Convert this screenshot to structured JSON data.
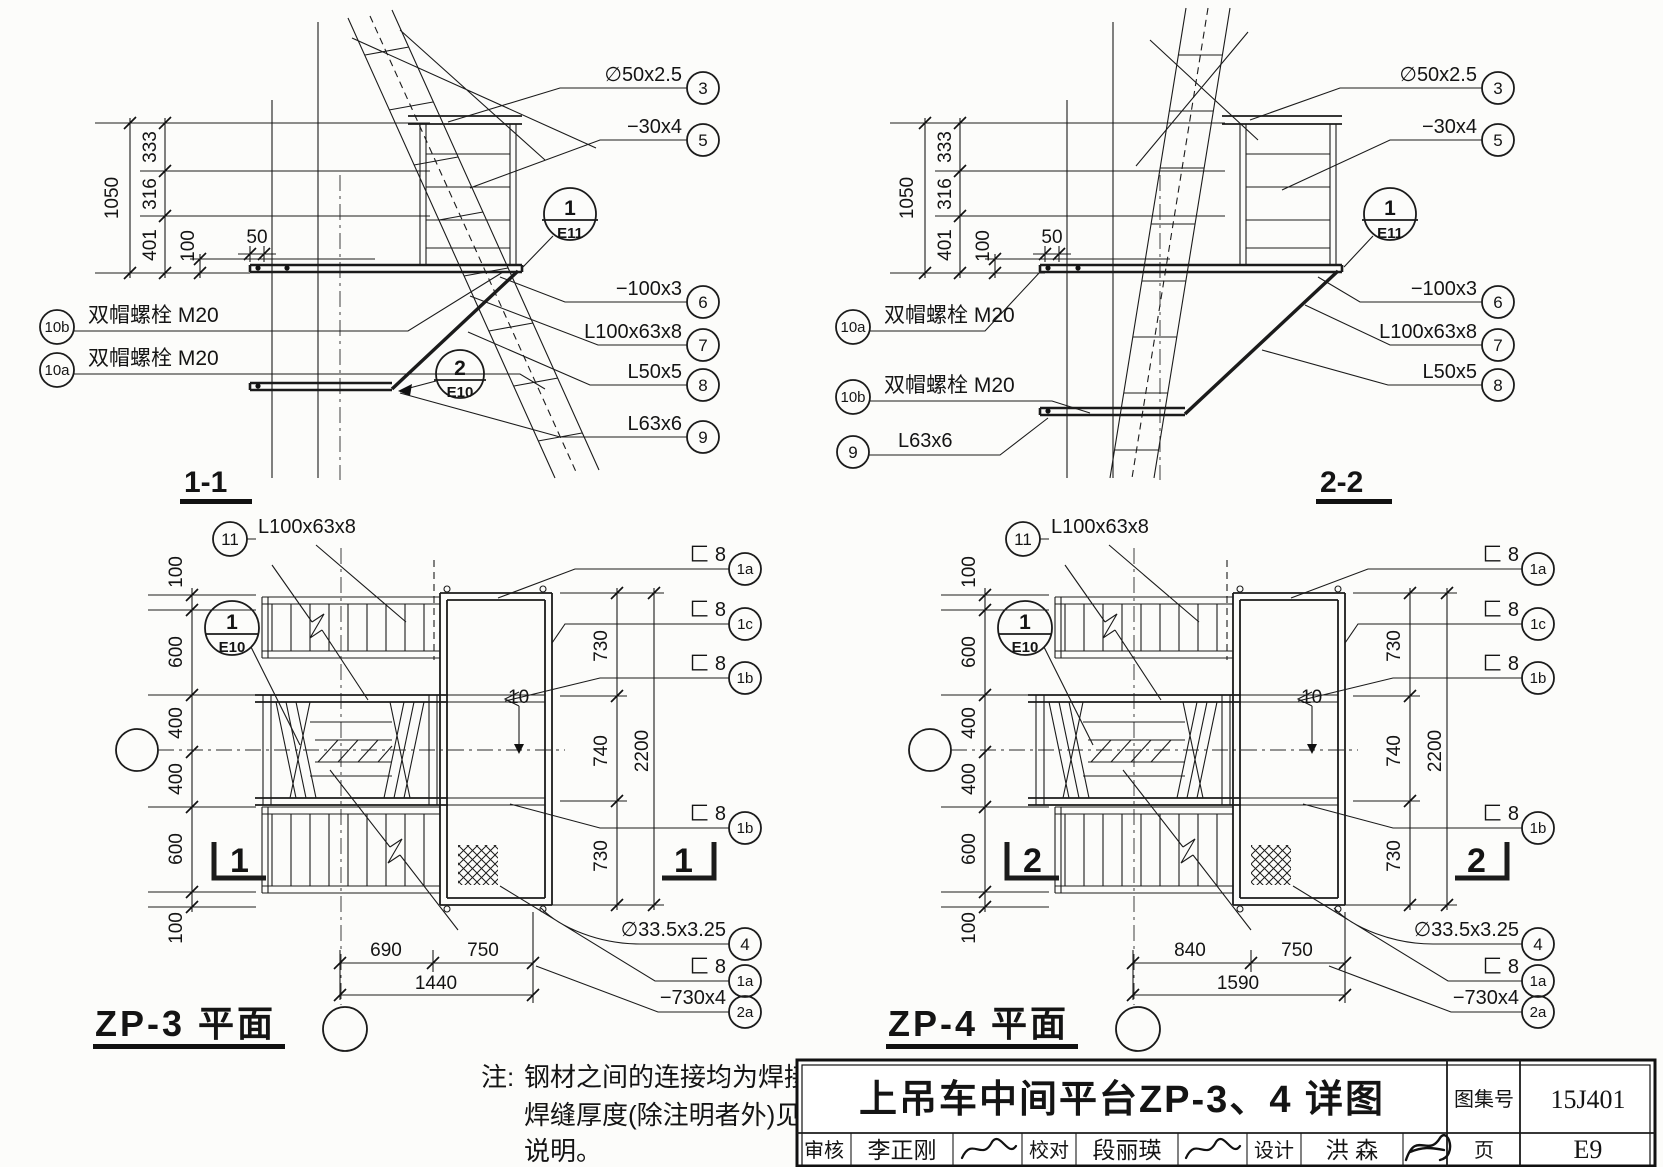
{
  "s11": {
    "title": "1-1",
    "dims": {
      "total": "1050",
      "a": "333",
      "b": "316",
      "c": "401",
      "d": "100",
      "e": "50"
    },
    "rc": [
      {
        "label": "∅50x2.5",
        "num": "3"
      },
      {
        "label": "−30x4",
        "num": "5"
      },
      {
        "label": "−100x3",
        "num": "6"
      },
      {
        "label": "L100x63x8",
        "num": "7"
      },
      {
        "label": "L50x5",
        "num": "8"
      },
      {
        "label": "L63x6",
        "num": "9"
      }
    ],
    "lc": [
      {
        "num": "10b",
        "label": "双帽螺栓 M20"
      },
      {
        "num": "10a",
        "label": "双帽螺栓 M20"
      }
    ],
    "det1": {
      "num": "1",
      "sheet": "E11"
    },
    "det2": {
      "num": "2",
      "sheet": "E10"
    }
  },
  "s22": {
    "title": "2-2",
    "dims": {
      "total": "1050",
      "a": "333",
      "b": "316",
      "c": "401",
      "d": "100",
      "e": "50"
    },
    "rc": [
      {
        "label": "∅50x2.5",
        "num": "3"
      },
      {
        "label": "−30x4",
        "num": "5"
      },
      {
        "label": "−100x3",
        "num": "6"
      },
      {
        "label": "L100x63x8",
        "num": "7"
      },
      {
        "label": "L50x5",
        "num": "8"
      }
    ],
    "lc": [
      {
        "num": "10a",
        "label": "双帽螺栓 M20"
      },
      {
        "num": "10b",
        "label": "双帽螺栓 M20"
      },
      {
        "num": "9",
        "label": "L63x6"
      }
    ],
    "det1": {
      "num": "1",
      "sheet": "E11"
    }
  },
  "zp3": {
    "title": "ZP-3 平面",
    "mark": "1",
    "ldims": [
      "100",
      "600",
      "400",
      "400",
      "600",
      "100"
    ],
    "rdims": {
      "a": "730",
      "b": "740",
      "c": "730",
      "total": "2200"
    },
    "weld": "10",
    "top": {
      "num": "11",
      "label": "L100x63x8"
    },
    "side": [
      {
        "label": "匚 8",
        "num": "1a"
      },
      {
        "label": "匚 8",
        "num": "1c"
      },
      {
        "label": "匚 8",
        "num": "1b"
      },
      {
        "label": "匚 8",
        "num": "1b"
      }
    ],
    "bot": [
      {
        "label": "∅33.5x3.25",
        "num": "4"
      },
      {
        "label": "匚 8",
        "num": "1a"
      },
      {
        "label": "−730x4",
        "num": "2a"
      }
    ],
    "bdims": {
      "a": "690",
      "b": "750",
      "total": "1440"
    },
    "det": {
      "num": "1",
      "sheet": "E10"
    }
  },
  "zp4": {
    "title": "ZP-4 平面",
    "mark": "2",
    "ldims": [
      "100",
      "600",
      "400",
      "400",
      "600",
      "100"
    ],
    "rdims": {
      "a": "730",
      "b": "740",
      "c": "730",
      "total": "2200"
    },
    "weld": "10",
    "top": {
      "num": "11",
      "label": "L100x63x8"
    },
    "side": [
      {
        "label": "匚 8",
        "num": "1a"
      },
      {
        "label": "匚 8",
        "num": "1c"
      },
      {
        "label": "匚 8",
        "num": "1b"
      },
      {
        "label": "匚 8",
        "num": "1b"
      }
    ],
    "bot": [
      {
        "label": "∅33.5x3.25",
        "num": "4"
      },
      {
        "label": "匚 8",
        "num": "1a"
      },
      {
        "label": "−730x4",
        "num": "2a"
      }
    ],
    "bdims": {
      "a": "840",
      "b": "750",
      "total": "1590"
    },
    "det": {
      "num": "1",
      "sheet": "E10"
    }
  },
  "note": {
    "prefix": "注:",
    "l1": "钢材之间的连接均为焊接，",
    "l2": "焊缝厚度(除注明者外)见",
    "l3": "说明。"
  },
  "tb": {
    "title": "上吊车中间平台ZP-3、4 详图",
    "atlas_label": "图集号",
    "atlas_no": "15J401",
    "page_label": "页",
    "page_no": "E9",
    "r1l": "审核",
    "r1v": "李正刚",
    "r2l": "校对",
    "r2v": "段丽瑛",
    "r3l": "设计",
    "r3v": "洪  森"
  }
}
